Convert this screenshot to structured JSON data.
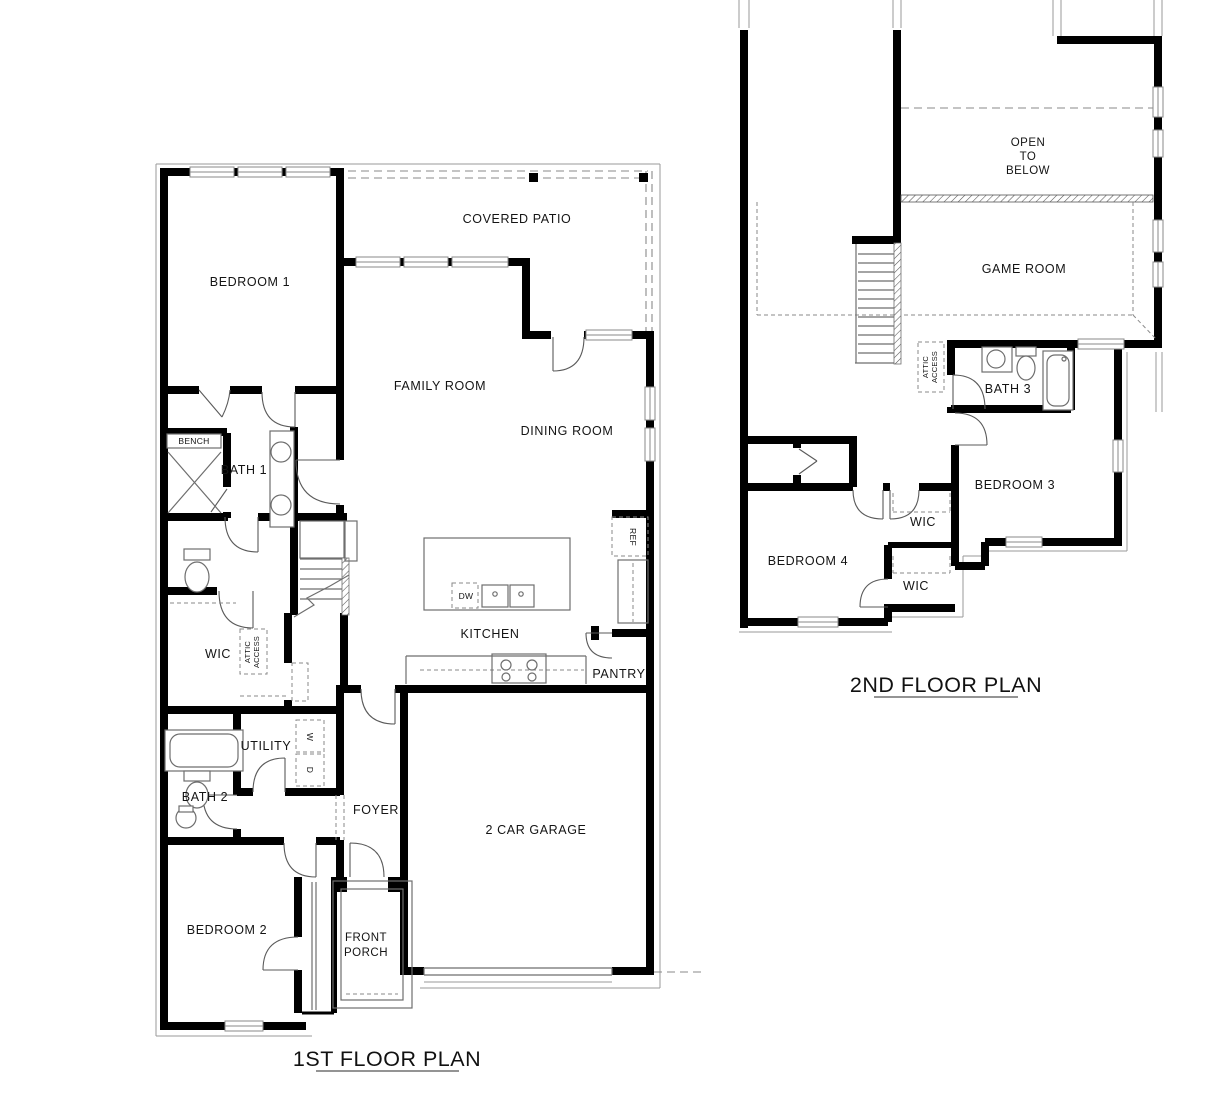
{
  "colors": {
    "wall": "#000000",
    "thin_line": "#6e6e6e",
    "dashed_line": "#8a8a8a",
    "text": "#141414",
    "background": "#ffffff"
  },
  "floor1": {
    "title": "1ST FLOOR PLAN",
    "labels": {
      "bedroom1": "BEDROOM 1",
      "covered_patio": "COVERED PATIO",
      "family_room": "FAMILY ROOM",
      "dining_room": "DINING ROOM",
      "bench": "BENCH",
      "bath1": "BATH 1",
      "wic": "WIC",
      "attic_l1": "ATTIC",
      "attic_l2": "ACCESS",
      "kitchen": "KITCHEN",
      "dw": "DW",
      "ref": "REF",
      "pantry": "PANTRY",
      "utility": "UTILITY",
      "washer": "W",
      "dryer": "D",
      "bath2": "BATH 2",
      "foyer": "FOYER",
      "garage": "2 CAR GARAGE",
      "bedroom2": "BEDROOM 2",
      "porch_l1": "FRONT",
      "porch_l2": "PORCH"
    }
  },
  "floor2": {
    "title": "2ND FLOOR PLAN",
    "labels": {
      "open_l1": "OPEN",
      "open_l2": "TO",
      "open_l3": "BELOW",
      "game_room": "GAME ROOM",
      "attic_l1": "ATTIC",
      "attic_l2": "ACCESS",
      "bath3": "BATH 3",
      "bedroom3": "BEDROOM 3",
      "wic_a": "WIC",
      "wic_b": "WIC",
      "bedroom4": "BEDROOM 4"
    }
  }
}
